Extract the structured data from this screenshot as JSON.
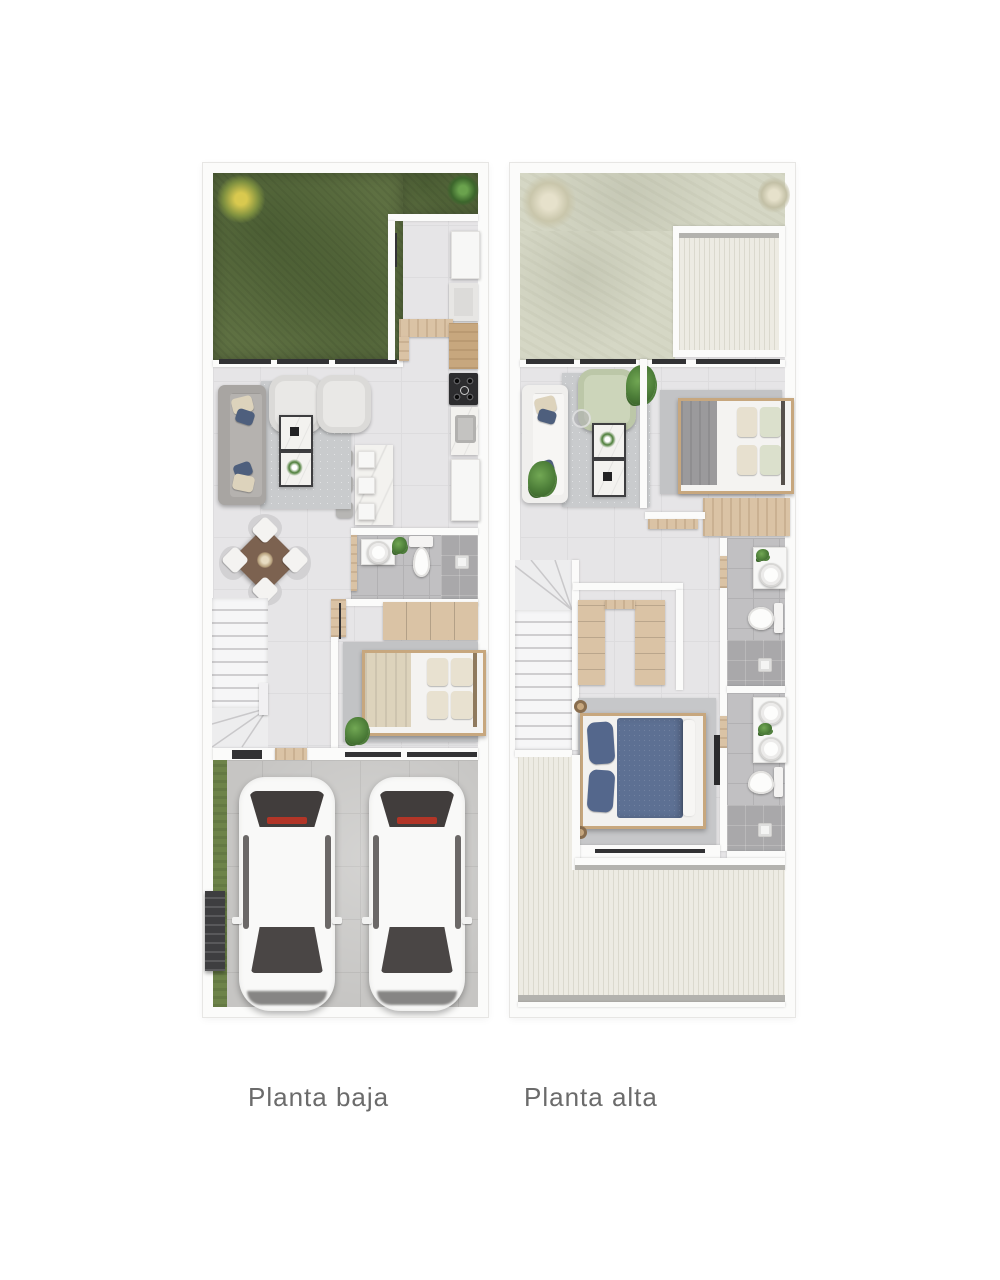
{
  "captions": {
    "left": "Planta baja",
    "right": "Planta alta"
  },
  "plans": {
    "left": {
      "id": "planta-baja",
      "rooms": [
        "garden",
        "kitchen",
        "living-room",
        "dining-room",
        "half-bathroom",
        "bedroom",
        "stairs",
        "entry-porch",
        "driveway"
      ]
    },
    "right": {
      "id": "planta-alta",
      "rooms": [
        "terrace",
        "roof-front",
        "family-room",
        "bedroom-2",
        "hallway",
        "bathroom-2",
        "walk-in-closet",
        "master-bedroom",
        "master-bathroom",
        "stairs",
        "roof-back"
      ]
    }
  },
  "colors": {
    "wall": "#fbfbfa",
    "wallShade": "#e7e6e4",
    "floor": "#e6e5e7",
    "floorLine": "#dddcde",
    "tile": "#c1c0c2",
    "tileLine": "#b2b1b3",
    "shower": "#a9a8aa",
    "concrete": "#c6c5c3",
    "concreteLine": "#b9b8b6",
    "grass": "#5e7042",
    "grassLight": "#6d8349",
    "terrace": "#d5d7c5",
    "roof": "#edebe3",
    "roofStripe": "#dbd9ce",
    "gutter": "#b3b2ae",
    "wood": "#dac3a5",
    "woodMid": "#c7a77e",
    "woodDark": "#7c6250",
    "marble": "#f3f2ef",
    "dark": "#323234",
    "red": "#b23527",
    "sofaGray": "#a8a5a2",
    "sofaSeat": "#b5b2af",
    "sofaWhite": "#f0efed",
    "rug": "#c9cbcd",
    "rugDark": "#c2c3c5",
    "cream": "#ddd3bc",
    "navy": "#4e5f7d",
    "bedBlue": "#5d7093",
    "pillowBlue": "#54678c",
    "sage": "#ccd5ba",
    "plant": "#4c7d38",
    "plantDark": "#3c662c",
    "plantYellow": "#d9c94f",
    "plantPale": "#e6e1cb",
    "white": "#f7f7f6",
    "text": "#6b6b6b"
  }
}
